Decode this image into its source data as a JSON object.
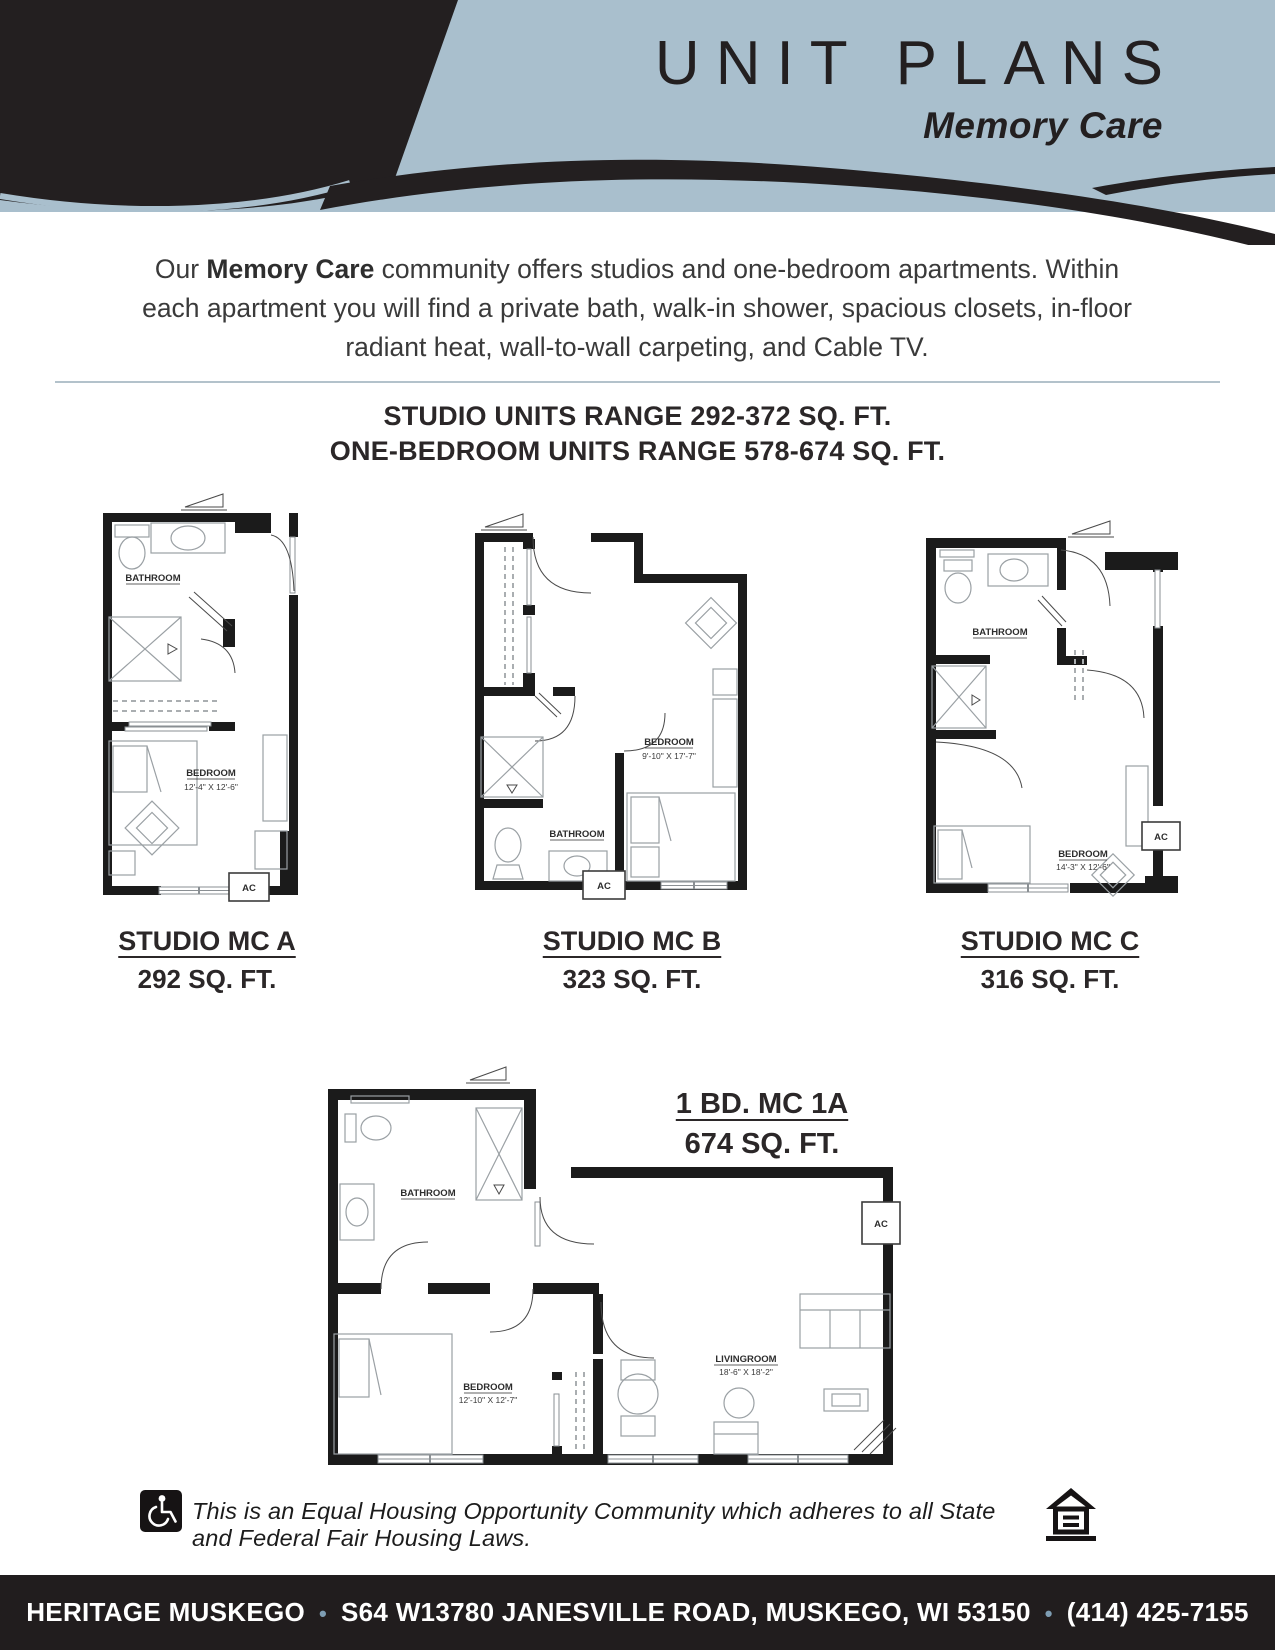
{
  "header": {
    "title": "UNIT PLANS",
    "subtitle": "Memory Care"
  },
  "intro": {
    "lead": "Our ",
    "bold": "Memory Care",
    "rest": " community offers studios and one-bedroom apartments. Within each apartment you will find a private bath, walk-in shower, spacious closets, in-floor radiant heat, wall-to-wall carpeting, and Cable TV."
  },
  "ranges": {
    "studio": "STUDIO UNITS RANGE 292-372 SQ. FT.",
    "one_bedroom": "ONE-BEDROOM UNITS RANGE 578-674 SQ. FT."
  },
  "plans": {
    "a": {
      "title": "STUDIO MC A",
      "sqft": "292 SQ. FT.",
      "bathroom_label": "BATHROOM",
      "bedroom_label": "BEDROOM",
      "bedroom_dims": "12'-4\" X 12'-6\"",
      "ac_label": "AC"
    },
    "b": {
      "title": "STUDIO MC B",
      "sqft": "323 SQ. FT.",
      "bathroom_label": "BATHROOM",
      "bedroom_label": "BEDROOM",
      "bedroom_dims": "9'-10\" X 17'-7\"",
      "ac_label": "AC"
    },
    "c": {
      "title": "STUDIO MC C",
      "sqft": "316 SQ. FT.",
      "bathroom_label": "BATHROOM",
      "bedroom_label": "BEDROOM",
      "bedroom_dims": "14'-3\" X 12'-6\"",
      "ac_label": "AC"
    },
    "one_bd": {
      "title": "1 BD. MC 1A",
      "sqft": "674 SQ. FT.",
      "bathroom_label": "BATHROOM",
      "bedroom_label": "BEDROOM",
      "bedroom_dims": "12'-10\" X 12'-7\"",
      "living_label": "LIVINGROOM",
      "living_dims": "18'-6\" X 18'-2\"",
      "ac_label": "AC"
    }
  },
  "legal": {
    "text": "This is an Equal Housing Opportunity Community which adheres to all State and Federal Fair Housing Laws."
  },
  "footer": {
    "name": "HERITAGE MUSKEGO",
    "bullet": "•",
    "address": "S64 W13780 JANESVILLE ROAD, MUSKEGO, WI 53150",
    "phone": "(414) 425-7155"
  },
  "colors": {
    "band": "#a9bfcd",
    "ink": "#231f20",
    "bullet": "#7e9db3"
  }
}
